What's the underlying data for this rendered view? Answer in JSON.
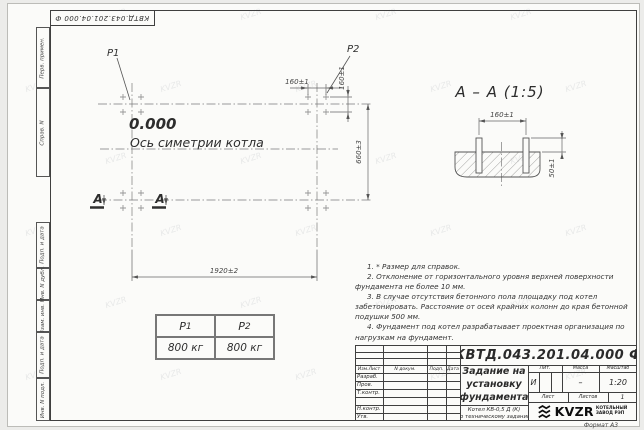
{
  "drawing": {
    "corner_stamp": "КВТД.043.201.04.000 Ф",
    "format_label": "Формат А3"
  },
  "margin_labels": {
    "perv_primen": "Перв. примен.",
    "sprav_n": "Справ. N",
    "podp_data_1": "Подп. и дата",
    "inv_dubl": "Инв. N дубл.",
    "vzam_inv": "Взам. инв. N",
    "podp_data_2": "Подп. и дата",
    "inv_podl": "Инв. N подл."
  },
  "plan": {
    "p1": "P1",
    "p2": "P2",
    "elevation": "0.000",
    "axis_label": "Ось симетрии котла",
    "section_mark": "А",
    "dim_width": "1920±2",
    "dim_depth": "660±3",
    "dim_bolt_x": "160±1",
    "dim_bolt_y": "160±1"
  },
  "section_view": {
    "title": "А – А (1:5)",
    "dim_bolt_spacing": "160±1",
    "dim_protrusion": "50±1"
  },
  "load_table": {
    "col1": {
      "symbol": "P",
      "sub": "1",
      "value": "800 кг"
    },
    "col2": {
      "symbol": "P",
      "sub": "2",
      "value": "800 кг"
    }
  },
  "notes": [
    "1. * Размер для справок.",
    "2. Отклонение от горизонтального уровня верхней поверхности фундамента не более 10 мм.",
    "3. В случае отсутствия бетонного пола площадку под котел забетонировать. Расстояние от осей крайних колонн до края бетонной подушки 500 мм.",
    "4. Фундамент под котел разрабатывает проектная организация по нагрузкам на фундамент."
  ],
  "title_block": {
    "doc_number": "КВТД.043.201.04.000 Ф",
    "header_cols": [
      "Изм.Лист",
      "N докум.",
      "Подп.",
      "Дата"
    ],
    "rows": [
      "Разраб.",
      "Пров.",
      "Т.контр.",
      "",
      "Н.контр.",
      "Утв."
    ],
    "title_line1": "Задание на",
    "title_line2": "установку",
    "title_line3": "фундамента",
    "subtitle_line1": "Котел КВ-0,5 Д (К)",
    "subtitle_line2": "по техническому заданию",
    "lit_label": "Лит.",
    "mass_label": "Масса",
    "scale_label": "Масштаб",
    "lit_value": "И",
    "mass_value": "–",
    "scale_value": "1:20",
    "sheet_label": "Лист",
    "sheets_label": "Листов",
    "sheets_value": "1",
    "logo_text": "KVZR",
    "company_line1": "КОТЕЛЬНЫЙ",
    "company_line2": "ЗАВОД РЭП"
  },
  "watermark": "KVZR"
}
